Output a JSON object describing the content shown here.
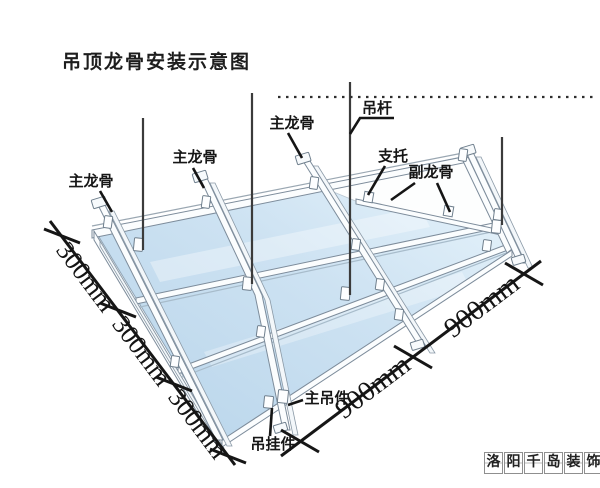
{
  "title": "吊顶龙骨安装示意图",
  "labels": {
    "hanger_rod": "吊杆",
    "main_keel": "主龙骨",
    "support": "支托",
    "sub_keel": "副龙骨",
    "main_hanger": "主吊件",
    "hanging_clip": "吊挂件"
  },
  "dimensions": {
    "left_spacing": "300mm",
    "left_count": 3,
    "right_spacing": "900mm",
    "right_count": 2
  },
  "watermark": {
    "text": "洛阳千岛装饰",
    "chars": [
      "洛",
      "阳",
      "千",
      "岛",
      "装",
      "饰"
    ]
  },
  "colors": {
    "panel_blue": "#bdd8ec",
    "panel_blue_light": "#e9f5fc",
    "keel_outline": "#7d8c9b",
    "line_black": "#1c1c1c"
  }
}
